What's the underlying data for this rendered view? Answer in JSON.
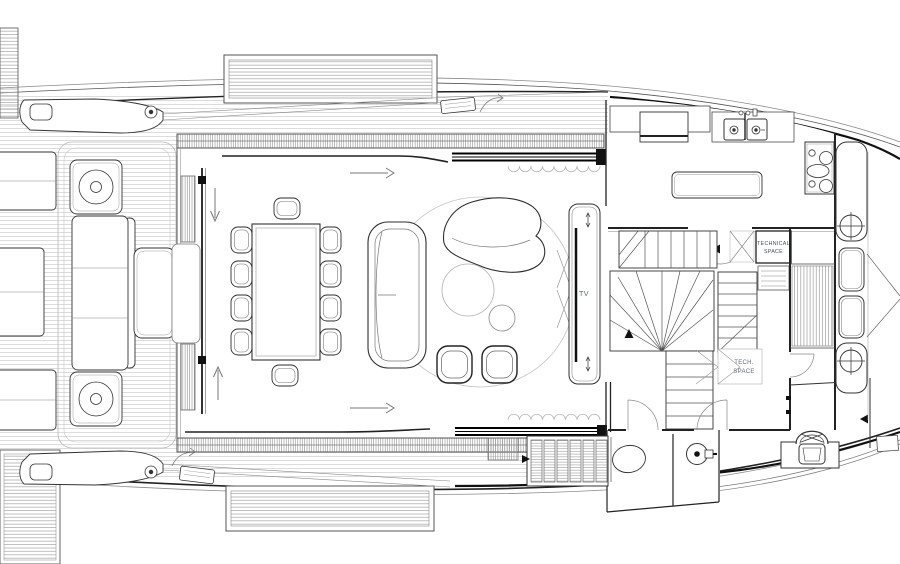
{
  "plan": {
    "type": "yacht-main-deck-floor-plan",
    "labels": {
      "tv": "TV",
      "technical_space": {
        "line1": "TECHNICAL",
        "line2": "SPACE"
      },
      "tech_space": {
        "line1": "TECH.",
        "line2": "SPACE"
      }
    },
    "icons": {
      "circulation_arrow_right": "→",
      "circulation_arrow_down": "↓",
      "circulation_arrow_up": "↑",
      "double_arrow_vertical": "↕"
    },
    "colors": {
      "background": "#ffffff",
      "line_dark": "#1c1c1c",
      "line_mid": "#4a4a4a",
      "line_light": "#9a9a9a",
      "plank": "#cdcdcd",
      "hatch": "#8f8f8f",
      "label_text": "#44505e",
      "label_text_light": "#5f6b76"
    }
  }
}
